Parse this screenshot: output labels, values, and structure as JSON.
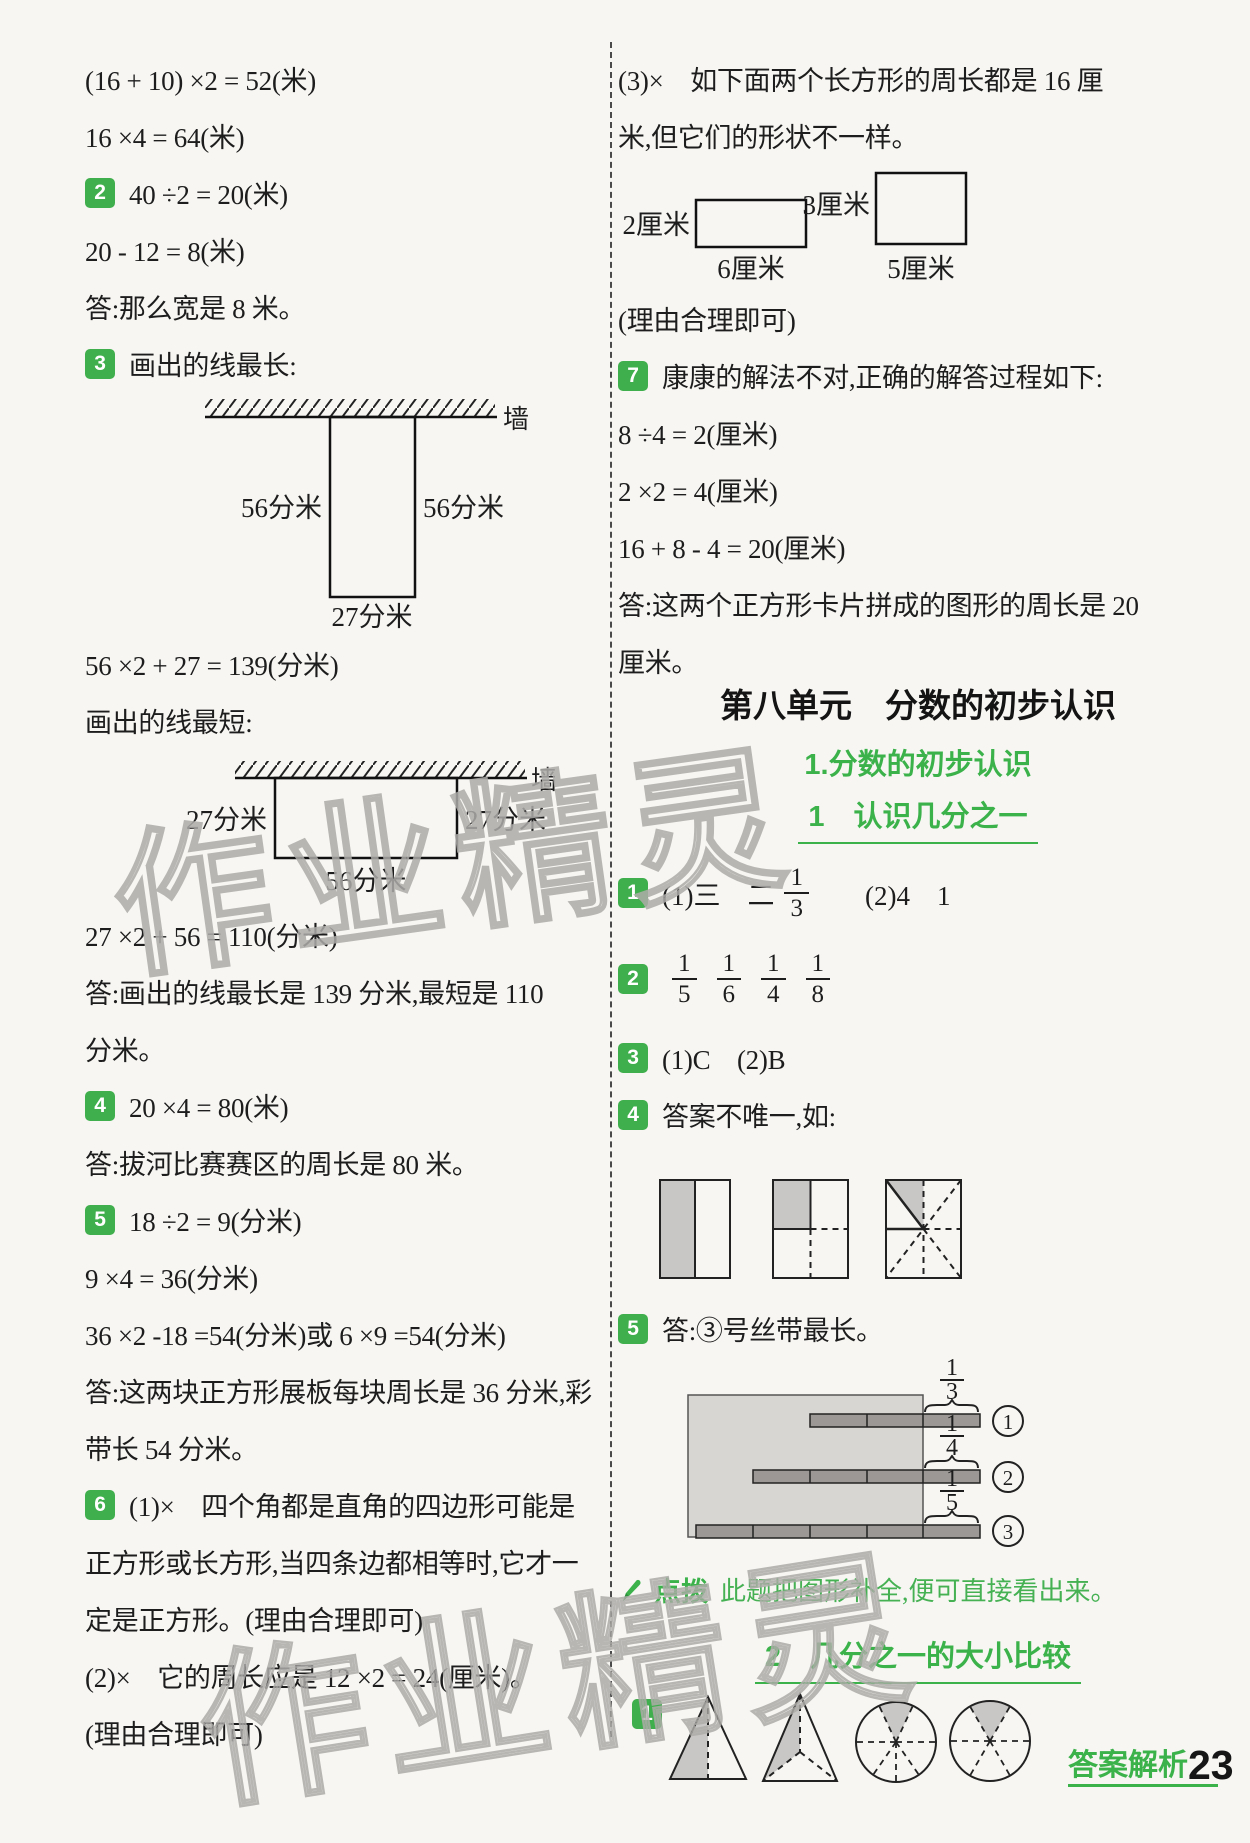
{
  "watermark": {
    "text": "作业精灵"
  },
  "footer": {
    "label": "答案解析",
    "page": "23"
  },
  "left": {
    "rows": [
      {
        "text": "(16 + 10) ×2 = 52(米)"
      },
      {
        "text": "16 ×4 = 64(米)"
      },
      {
        "badge": "2",
        "text": "40 ÷2 = 20(米)"
      },
      {
        "text": "20 - 12 = 8(米)"
      },
      {
        "text": "答:那么宽是 8 米。"
      },
      {
        "badge": "3",
        "text": "画出的线最长:"
      },
      {
        "text": "56 ×2 + 27 = 139(分米)"
      },
      {
        "text": "画出的线最短:"
      },
      {
        "text": "27 ×2 + 56 = 110(分米)"
      },
      {
        "text": "答:画出的线最长是 139 分米,最短是 110"
      },
      {
        "text": "分米。"
      },
      {
        "badge": "4",
        "text": "20 ×4 = 80(米)"
      },
      {
        "text": "答:拔河比赛赛区的周长是 80 米。"
      },
      {
        "badge": "5",
        "text": "18 ÷2 = 9(分米)"
      },
      {
        "text": "9 ×4 = 36(分米)"
      },
      {
        "text": "36 ×2 -18 =54(分米)或 6 ×9 =54(分米)"
      },
      {
        "text": "答:这两块正方形展板每块周长是 36 分米,彩"
      },
      {
        "text": "带长 54 分米。"
      },
      {
        "badge": "6",
        "text": "(1)×　四个角都是直角的四边形可能是"
      },
      {
        "text": "正方形或长方形,当四条边都相等时,它才一"
      },
      {
        "text": "定是正方形。(理由合理即可)"
      },
      {
        "text": "(2)×　它的周长应是 12 ×2 = 24(厘米)。"
      },
      {
        "text": "(理由合理即可)"
      }
    ],
    "wall_long": {
      "wall": "墙",
      "left": "56分米",
      "right": "56分米",
      "bottom": "27分米"
    },
    "wall_short": {
      "wall": "墙",
      "left": "27分米",
      "right": "27分米",
      "bottom": "56分米"
    }
  },
  "right": {
    "rows_top": [
      {
        "text": "(3)×　如下面两个长方形的周长都是 16 厘"
      },
      {
        "text": "米,但它们的形状不一样。"
      }
    ],
    "rects": [
      {
        "side": "2厘米",
        "bottom": "6厘米"
      },
      {
        "side": "3厘米",
        "bottom": "5厘米"
      }
    ],
    "rows_mid": [
      {
        "text": "(理由合理即可)"
      },
      {
        "badge": "7",
        "text": "康康的解法不对,正确的解答过程如下:"
      },
      {
        "text": "8 ÷4 = 2(厘米)"
      },
      {
        "text": "2 ×2 = 4(厘米)"
      },
      {
        "text": "16 + 8 - 4 = 20(厘米)"
      },
      {
        "text": "答:这两个正方形卡片拼成的图形的周长是 20"
      },
      {
        "text": "厘米。"
      }
    ],
    "unit_title": "第八单元　分数的初步认识",
    "section_title": "1.分数的初步认识",
    "lesson1_title": "1　认识几分之一",
    "ans1": {
      "badge": "1",
      "pre": "(1)三　二",
      "frac": {
        "n": "1",
        "d": "3"
      },
      "post": "(2)4　1"
    },
    "ans2": {
      "badge": "2",
      "fracs": [
        {
          "n": "1",
          "d": "5"
        },
        {
          "n": "1",
          "d": "6"
        },
        {
          "n": "1",
          "d": "4"
        },
        {
          "n": "1",
          "d": "8"
        }
      ]
    },
    "ans3": {
      "badge": "3",
      "text": "(1)C　(2)B"
    },
    "ans4": {
      "badge": "4",
      "text": "答案不唯一,如:"
    },
    "ans5": {
      "badge": "5",
      "text": "答:③号丝带最长。"
    },
    "ribbon": {
      "items": [
        {
          "frac": {
            "n": "1",
            "d": "3"
          },
          "num": "1"
        },
        {
          "frac": {
            "n": "1",
            "d": "4"
          },
          "num": "2"
        },
        {
          "frac": {
            "n": "1",
            "d": "5"
          },
          "num": "3"
        }
      ]
    },
    "tip": {
      "label": "点拨",
      "text": "此题把图形补全,便可直接看出来。"
    },
    "lesson2_title": "2　几分之一的大小比较",
    "ans_cmp1": {
      "badge": "1"
    }
  }
}
